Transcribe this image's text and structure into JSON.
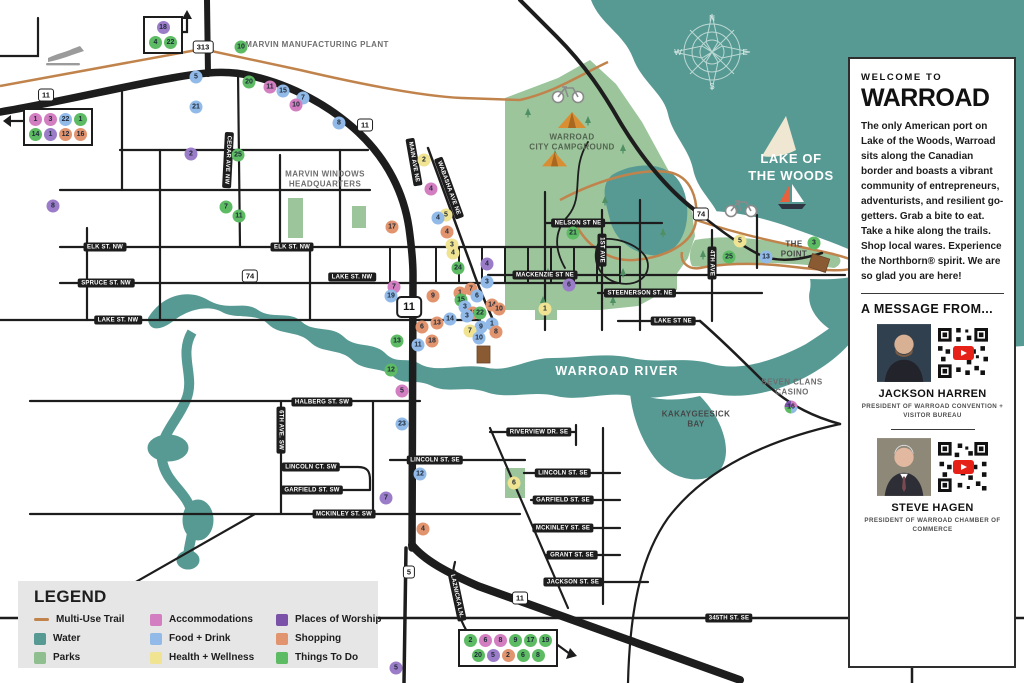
{
  "sidebar": {
    "welcome": "WELCOME TO",
    "brand": "WARROAD",
    "intro": "The only American port on Lake of the Woods, Warroad sits along the Canadian border and boasts a vibrant community of entrepreneurs, adventurists, and resilient go-getters. Grab a bite to eat. Take a hike along the trails. Shop local wares. Experience the Northborn® spirit. We are so glad you are here!",
    "message_heading": "A MESSAGE FROM...",
    "people": [
      {
        "name": "JACKSON HARREN",
        "role": "PRESIDENT OF WARROAD CONVENTION + VISITOR BUREAU"
      },
      {
        "name": "STEVE HAGEN",
        "role": "PRESIDENT OF WARROAD CHAMBER OF COMMERCE"
      }
    ]
  },
  "legend": {
    "title": "LEGEND",
    "items": [
      {
        "label": "Multi-Use Trail",
        "color": "#C1834C",
        "swatch": "line"
      },
      {
        "label": "Water",
        "color": "#579A94",
        "swatch": "square"
      },
      {
        "label": "Parks",
        "color": "#8FBF8F",
        "swatch": "square"
      },
      {
        "label": "Accommodations",
        "color": "#D27EC0",
        "swatch": "square"
      },
      {
        "label": "Food + Drink",
        "color": "#92BAE8",
        "swatch": "square"
      },
      {
        "label": "Health + Wellness",
        "color": "#F0E392",
        "swatch": "square"
      },
      {
        "label": "Places of Worship",
        "color": "#7A52A8",
        "swatch": "square"
      },
      {
        "label": "Shopping",
        "color": "#E2946E",
        "swatch": "square"
      },
      {
        "label": "Things To Do",
        "color": "#5DBB63",
        "swatch": "square"
      }
    ]
  },
  "map": {
    "category_colors": {
      "stay": "#D27EC0",
      "food": "#92BAE8",
      "health": "#F0E392",
      "worship": "#9B7CC8",
      "shop": "#E2946E",
      "things": "#5DBB63"
    },
    "area_labels": [
      {
        "t": "MARVIN MANUFACTURING PLANT",
        "x": 317,
        "y": 45,
        "s": "gray"
      },
      {
        "t": "MARVIN WINDOWS\nHEADQUARTERS",
        "x": 325,
        "y": 180,
        "s": "gray"
      },
      {
        "t": "WARROAD\nCITY CAMPGROUND",
        "x": 572,
        "y": 143,
        "s": "camp"
      },
      {
        "t": "LAKE OF\nTHE WOODS",
        "x": 791,
        "y": 168,
        "s": "lake"
      },
      {
        "t": "THE\nPOINT",
        "x": 794,
        "y": 250,
        "s": "dark"
      },
      {
        "t": "WARROAD RIVER",
        "x": 617,
        "y": 371,
        "s": "river"
      },
      {
        "t": "SEVEN CLANS\nCASINO",
        "x": 792,
        "y": 388,
        "s": "gray"
      },
      {
        "t": "KAKAYGEESICK\nBAY",
        "x": 696,
        "y": 420,
        "s": "dark"
      }
    ],
    "street_signs": [
      {
        "t": "ELK ST. NW",
        "x": 105,
        "y": 247
      },
      {
        "t": "ELK ST. NW",
        "x": 292,
        "y": 247
      },
      {
        "t": "SPRUCE ST. NW",
        "x": 106,
        "y": 283
      },
      {
        "t": "LAKE ST. NW",
        "x": 118,
        "y": 320
      },
      {
        "t": "LAKE ST. NW",
        "x": 352,
        "y": 277
      },
      {
        "t": "CEDAR AVE NW",
        "x": 228,
        "y": 160,
        "r": 93
      },
      {
        "t": "MAIN AVE NE",
        "x": 414,
        "y": 162,
        "r": 80
      },
      {
        "t": "WABASHA AVE NE",
        "x": 449,
        "y": 188,
        "r": 70
      },
      {
        "t": "NELSON ST NE",
        "x": 578,
        "y": 223
      },
      {
        "t": "1ST AVE",
        "x": 602,
        "y": 250,
        "r": 90
      },
      {
        "t": "MACKENZIE ST NE",
        "x": 545,
        "y": 275
      },
      {
        "t": "STEENERSON ST. NE",
        "x": 640,
        "y": 293
      },
      {
        "t": "LAKE ST NE",
        "x": 673,
        "y": 321
      },
      {
        "t": "4TH AVE",
        "x": 712,
        "y": 263,
        "r": 90
      },
      {
        "t": "HALBERG ST. SW",
        "x": 322,
        "y": 402
      },
      {
        "t": "6TH AVE. SW",
        "x": 281,
        "y": 430,
        "r": 90
      },
      {
        "t": "LINCOLN CT. SW",
        "x": 311,
        "y": 467
      },
      {
        "t": "GARFIELD ST. SW",
        "x": 312,
        "y": 490
      },
      {
        "t": "MCKINLEY ST. SW",
        "x": 344,
        "y": 514
      },
      {
        "t": "LINCOLN ST. SE",
        "x": 435,
        "y": 460
      },
      {
        "t": "RIVERVIEW DR. SE",
        "x": 539,
        "y": 432
      },
      {
        "t": "LINCOLN ST. SE",
        "x": 563,
        "y": 473
      },
      {
        "t": "GARFIELD ST. SE",
        "x": 563,
        "y": 500
      },
      {
        "t": "MCKINLEY ST. SE",
        "x": 563,
        "y": 528
      },
      {
        "t": "GRANT ST. SE",
        "x": 572,
        "y": 555
      },
      {
        "t": "JACKSON ST. SE",
        "x": 573,
        "y": 582
      },
      {
        "t": "LAZNICKA LN.",
        "x": 457,
        "y": 596,
        "r": 78
      },
      {
        "t": "345TH ST. SE",
        "x": 729,
        "y": 618
      }
    ],
    "highway_shields": [
      {
        "n": "11",
        "x": 46,
        "y": 95
      },
      {
        "n": "313",
        "x": 203,
        "y": 47
      },
      {
        "n": "11",
        "x": 365,
        "y": 125
      },
      {
        "n": "74",
        "x": 250,
        "y": 276
      },
      {
        "n": "74",
        "x": 701,
        "y": 214
      },
      {
        "n": "11",
        "x": 409,
        "y": 307,
        "big": true
      },
      {
        "n": "5",
        "x": 409,
        "y": 572
      },
      {
        "n": "11",
        "x": 520,
        "y": 598
      }
    ],
    "markers": [
      {
        "n": "10",
        "c": "things",
        "x": 241,
        "y": 47
      },
      {
        "n": "5",
        "c": "food",
        "x": 196,
        "y": 77
      },
      {
        "n": "20",
        "c": "things",
        "x": 249,
        "y": 82
      },
      {
        "n": "11",
        "c": "stay",
        "x": 270,
        "y": 87
      },
      {
        "n": "15",
        "c": "food",
        "x": 283,
        "y": 91
      },
      {
        "n": "7",
        "c": "food",
        "x": 303,
        "y": 98
      },
      {
        "n": "10",
        "c": "stay",
        "x": 296,
        "y": 105
      },
      {
        "n": "21",
        "c": "food",
        "x": 196,
        "y": 107
      },
      {
        "n": "8",
        "c": "food",
        "x": 339,
        "y": 123
      },
      {
        "n": "2",
        "c": "worship",
        "x": 191,
        "y": 154
      },
      {
        "n": "25",
        "c": "things",
        "x": 238,
        "y": 155
      },
      {
        "n": "2",
        "c": "health",
        "x": 424,
        "y": 160
      },
      {
        "n": "4",
        "c": "stay",
        "x": 431,
        "y": 189
      },
      {
        "n": "8",
        "c": "worship",
        "x": 53,
        "y": 206
      },
      {
        "n": "7",
        "c": "things",
        "x": 226,
        "y": 207
      },
      {
        "n": "11",
        "c": "things",
        "x": 239,
        "y": 216
      },
      {
        "n": "5",
        "c": "health",
        "x": 446,
        "y": 215
      },
      {
        "n": "4",
        "c": "food",
        "x": 438,
        "y": 218
      },
      {
        "n": "17",
        "c": "shop",
        "x": 392,
        "y": 227
      },
      {
        "n": "4",
        "c": "shop",
        "x": 447,
        "y": 232
      },
      {
        "n": "21",
        "c": "things",
        "x": 573,
        "y": 233
      },
      {
        "n": "5",
        "c": "health",
        "x": 740,
        "y": 241
      },
      {
        "n": "3",
        "c": "things",
        "x": 814,
        "y": 243
      },
      {
        "n": "3",
        "c": "health",
        "x": 452,
        "y": 245
      },
      {
        "n": "4",
        "c": "health",
        "x": 453,
        "y": 253
      },
      {
        "n": "25",
        "c": "things",
        "x": 729,
        "y": 257
      },
      {
        "n": "13",
        "c": "food",
        "x": 766,
        "y": 257
      },
      {
        "n": "4",
        "c": "worship",
        "x": 487,
        "y": 264
      },
      {
        "n": "24",
        "c": "things",
        "x": 458,
        "y": 268
      },
      {
        "n": "3",
        "c": "food",
        "x": 487,
        "y": 282
      },
      {
        "n": "6",
        "c": "worship",
        "x": 569,
        "y": 285
      },
      {
        "n": "7",
        "c": "stay",
        "x": 394,
        "y": 287
      },
      {
        "n": "7",
        "c": "shop",
        "x": 471,
        "y": 289
      },
      {
        "n": "1",
        "c": "shop",
        "x": 460,
        "y": 293
      },
      {
        "n": "19",
        "c": "food",
        "x": 391,
        "y": 296
      },
      {
        "n": "9",
        "c": "shop",
        "x": 433,
        "y": 296
      },
      {
        "n": "6",
        "c": "food",
        "x": 477,
        "y": 296
      },
      {
        "n": "15",
        "c": "things",
        "x": 461,
        "y": 300
      },
      {
        "n": "14",
        "c": "shop",
        "x": 492,
        "y": 305
      },
      {
        "n": "3",
        "c": "food",
        "x": 465,
        "y": 307
      },
      {
        "n": "1",
        "c": "health",
        "x": 545,
        "y": 309
      },
      {
        "n": "10",
        "c": "shop",
        "x": 499,
        "y": 309
      },
      {
        "n": "18",
        "c": "shop",
        "x": 473,
        "y": 313
      },
      {
        "n": "22",
        "c": "things",
        "x": 480,
        "y": 313
      },
      {
        "n": "3",
        "c": "food",
        "x": 467,
        "y": 316
      },
      {
        "n": "14",
        "c": "food",
        "x": 450,
        "y": 319
      },
      {
        "n": "13",
        "c": "shop",
        "x": 437,
        "y": 323
      },
      {
        "n": "1",
        "c": "food",
        "x": 492,
        "y": 324
      },
      {
        "n": "9",
        "c": "food",
        "x": 481,
        "y": 327
      },
      {
        "n": "6",
        "c": "shop",
        "x": 422,
        "y": 327
      },
      {
        "n": "7",
        "c": "health",
        "x": 470,
        "y": 331
      },
      {
        "n": "8",
        "c": "shop",
        "x": 496,
        "y": 332
      },
      {
        "n": "10",
        "c": "food",
        "x": 479,
        "y": 338
      },
      {
        "n": "18",
        "c": "shop",
        "x": 432,
        "y": 341
      },
      {
        "n": "13",
        "c": "things",
        "x": 397,
        "y": 341
      },
      {
        "n": "11",
        "c": "food",
        "x": 418,
        "y": 345
      },
      {
        "n": "12",
        "c": "things",
        "x": 391,
        "y": 370
      },
      {
        "n": "5",
        "c": "stay",
        "x": 402,
        "y": 391
      },
      {
        "n": "16",
        "c": "casino",
        "x": 791,
        "y": 407
      },
      {
        "n": "23",
        "c": "food",
        "x": 402,
        "y": 424
      },
      {
        "n": "12",
        "c": "food",
        "x": 420,
        "y": 474
      },
      {
        "n": "6",
        "c": "health",
        "x": 514,
        "y": 483
      },
      {
        "n": "7",
        "c": "worship",
        "x": 386,
        "y": 498
      },
      {
        "n": "4",
        "c": "shop",
        "x": 423,
        "y": 529
      },
      {
        "n": "5",
        "c": "worship",
        "x": 396,
        "y": 668
      }
    ],
    "marker_groups": [
      {
        "x": 143,
        "y": 16,
        "rows": [
          [
            {
              "n": "18",
              "c": "worship"
            }
          ],
          [
            {
              "n": "4",
              "c": "things"
            },
            {
              "n": "22",
              "c": "things"
            }
          ]
        ]
      },
      {
        "x": 23,
        "y": 108,
        "rows": [
          [
            {
              "n": "1",
              "c": "stay"
            },
            {
              "n": "3",
              "c": "stay"
            },
            {
              "n": "22",
              "c": "food"
            },
            {
              "n": "1",
              "c": "things"
            }
          ],
          [
            {
              "n": "14",
              "c": "things"
            },
            {
              "n": "1",
              "c": "worship"
            },
            {
              "n": "12",
              "c": "shop"
            },
            {
              "n": "16",
              "c": "shop"
            }
          ]
        ]
      },
      {
        "x": 458,
        "y": 629,
        "rows": [
          [
            {
              "n": "2",
              "c": "things"
            },
            {
              "n": "6",
              "c": "stay"
            },
            {
              "n": "8",
              "c": "stay"
            },
            {
              "n": "9",
              "c": "things"
            },
            {
              "n": "17",
              "c": "things"
            },
            {
              "n": "19",
              "c": "things"
            }
          ],
          [
            {
              "n": "20",
              "c": "things"
            },
            {
              "n": "5",
              "c": "worship"
            },
            {
              "n": "2",
              "c": "shop"
            },
            {
              "n": "6",
              "c": "things"
            },
            {
              "n": "8",
              "c": "things"
            }
          ]
        ]
      }
    ]
  }
}
